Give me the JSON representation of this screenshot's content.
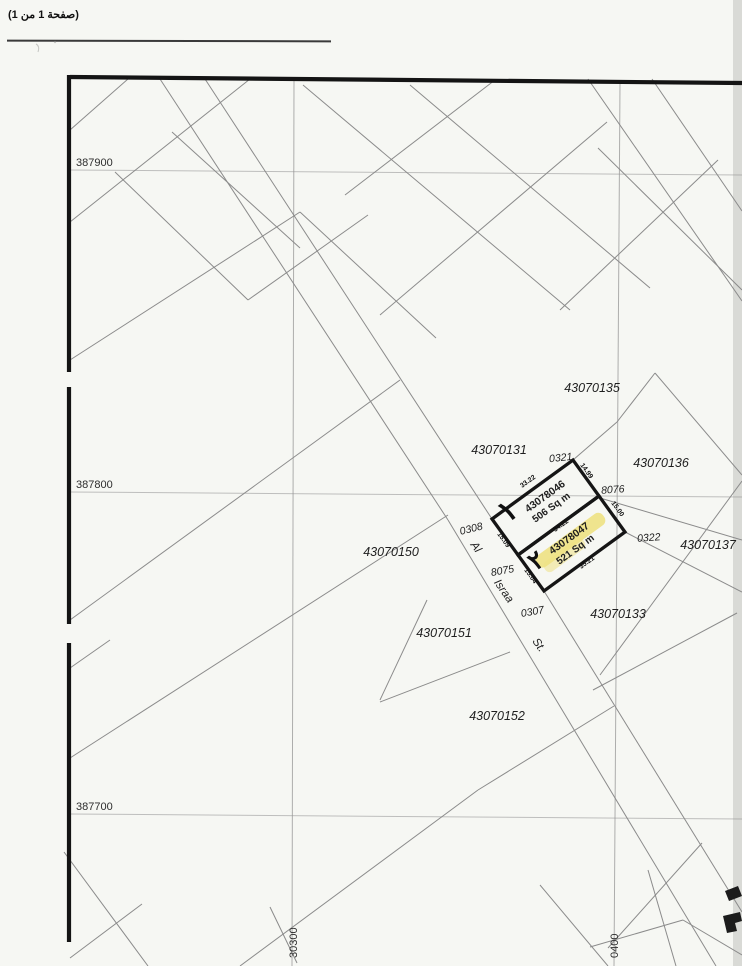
{
  "header": {
    "page_info": "(صفحة 1 من 1)"
  },
  "map": {
    "highlight_color": "#eee183",
    "grid": {
      "y_labels": [
        {
          "label": "387900"
        },
        {
          "label": "387800"
        },
        {
          "label": "387700"
        }
      ],
      "x_labels": [
        {
          "label": "30300"
        },
        {
          "label": "0400"
        }
      ]
    },
    "parcels": [
      {
        "label": "43070135"
      },
      {
        "label": "43070131"
      },
      {
        "label": "43070136"
      },
      {
        "label": "43070137"
      },
      {
        "label": "43070150"
      },
      {
        "label": "43070151"
      },
      {
        "label": "43070133"
      },
      {
        "label": "43070152"
      }
    ],
    "street_numbers": [
      {
        "label": "0321"
      },
      {
        "label": "0308"
      },
      {
        "label": "8076"
      },
      {
        "label": "0322"
      },
      {
        "label": "8075"
      },
      {
        "label": "0307"
      }
    ],
    "street_name": [
      {
        "label": "Al"
      },
      {
        "label": "Israa"
      },
      {
        "label": "St."
      }
    ],
    "plots": [
      {
        "number": "43078046",
        "area": "506 Sq m",
        "index_glyph": "١",
        "dims": [
          {
            "label": "33.22"
          },
          {
            "label": "14.99"
          },
          {
            "label": "34.22"
          },
          {
            "label": "15.09"
          }
        ]
      },
      {
        "number": "43078047",
        "area": "521 Sq m",
        "index_glyph": "٢",
        "dims": [
          {
            "label": "35.21"
          },
          {
            "label": "15.04"
          },
          {
            "label": "15.00"
          }
        ]
      }
    ]
  }
}
